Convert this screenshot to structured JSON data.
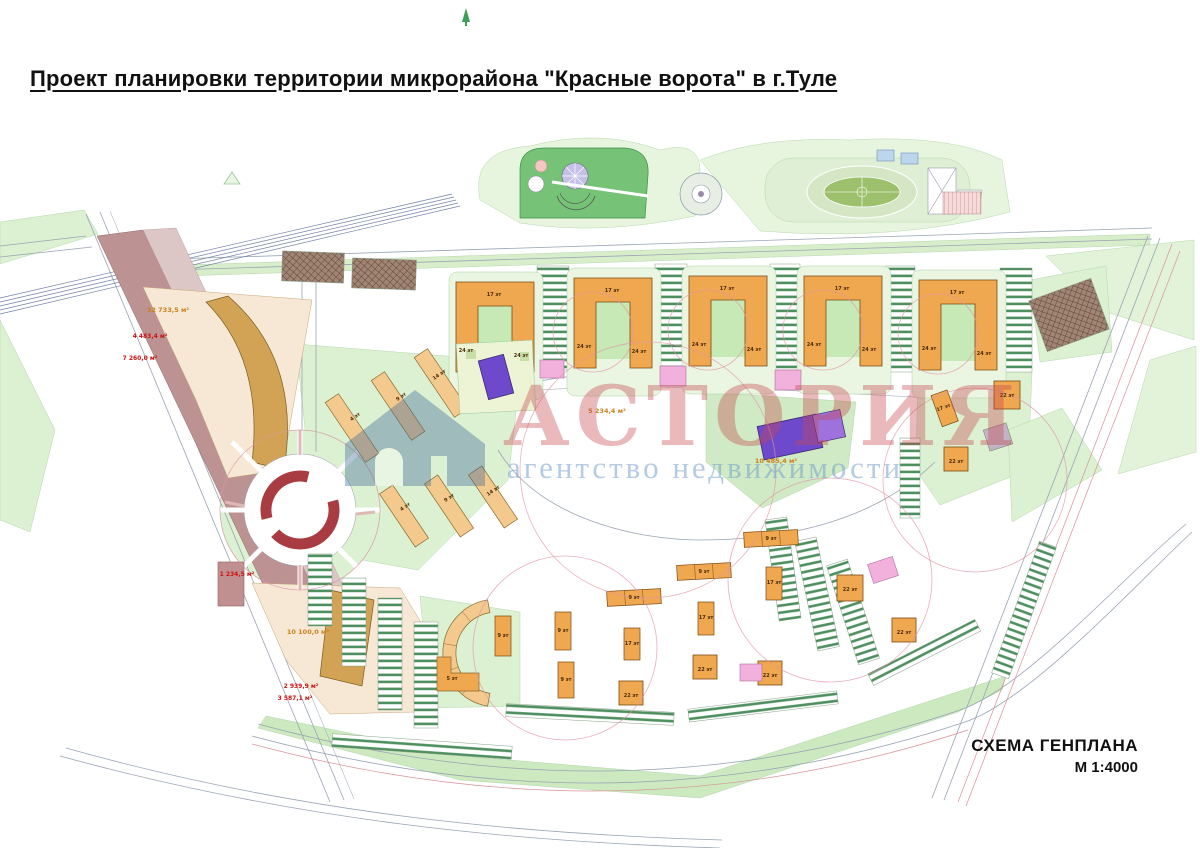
{
  "title": "Проект планировки территории микрорайона \"Красные ворота\" в г.Туле",
  "footer": {
    "scheme_label": "СХЕМА ГЕНПЛАНА",
    "scale_label": "М 1:4000"
  },
  "watermark": {
    "name": "АСТОРИЯ",
    "subtitle": "агентство недвижимости",
    "logo": "house-icon"
  },
  "palette": {
    "building_orange": "#efa750",
    "building_pale_orange": "#f3c98e",
    "building_tan": "#d2a355",
    "building_purple": "#6e49cb",
    "building_purple_light": "#9e72dc",
    "substation_pink": "#f2b0dc",
    "green_light": "#dcf0d2",
    "green_court": "#c6e9b6",
    "park_green": "#76c276",
    "corridor_mauve": "#bc9292",
    "parcel_beige": "#f6e8d4",
    "ring_red": "#a93b42",
    "label_red": "#c81414",
    "label_orange": "#c8821e"
  },
  "map": {
    "labels": [
      {
        "t": "17 эт",
        "x": 494,
        "y": 296,
        "c": "bld"
      },
      {
        "t": "24 эт",
        "x": 466,
        "y": 352,
        "c": "bld"
      },
      {
        "t": "24 эт",
        "x": 521,
        "y": 357,
        "c": "bld"
      },
      {
        "t": "17 эт",
        "x": 612,
        "y": 292,
        "c": "bld"
      },
      {
        "t": "24 эт",
        "x": 584,
        "y": 348,
        "c": "bld"
      },
      {
        "t": "24 эт",
        "x": 639,
        "y": 353,
        "c": "bld"
      },
      {
        "t": "17 эт",
        "x": 727,
        "y": 290,
        "c": "bld"
      },
      {
        "t": "24 эт",
        "x": 699,
        "y": 346,
        "c": "bld"
      },
      {
        "t": "24 эт",
        "x": 754,
        "y": 351,
        "c": "bld"
      },
      {
        "t": "17 эт",
        "x": 842,
        "y": 290,
        "c": "bld"
      },
      {
        "t": "24 эт",
        "x": 814,
        "y": 346,
        "c": "bld"
      },
      {
        "t": "24 эт",
        "x": 869,
        "y": 351,
        "c": "bld"
      },
      {
        "t": "17 эт",
        "x": 957,
        "y": 294,
        "c": "bld"
      },
      {
        "t": "24 эт",
        "x": 929,
        "y": 350,
        "c": "bld"
      },
      {
        "t": "24 эт",
        "x": 984,
        "y": 355,
        "c": "bld"
      },
      {
        "t": "4 эт",
        "x": 356,
        "y": 418,
        "c": "bld",
        "r": -34
      },
      {
        "t": "9 эт",
        "x": 402,
        "y": 398,
        "c": "bld",
        "r": -34
      },
      {
        "t": "14 эт",
        "x": 440,
        "y": 376,
        "c": "bld",
        "r": -34
      },
      {
        "t": "4 эт",
        "x": 406,
        "y": 508,
        "c": "bld",
        "r": -34
      },
      {
        "t": "9 эт",
        "x": 450,
        "y": 499,
        "c": "bld",
        "r": -34
      },
      {
        "t": "14 эт",
        "x": 494,
        "y": 492,
        "c": "bld",
        "r": -34
      },
      {
        "t": "9 эт",
        "x": 771,
        "y": 540,
        "c": "bld"
      },
      {
        "t": "9 эт",
        "x": 704,
        "y": 573,
        "c": "bld"
      },
      {
        "t": "9 эт",
        "x": 634,
        "y": 599,
        "c": "bld"
      },
      {
        "t": "9 эт",
        "x": 503,
        "y": 637,
        "c": "bld"
      },
      {
        "t": "9 эт",
        "x": 563,
        "y": 632,
        "c": "bld"
      },
      {
        "t": "9 эт",
        "x": 566,
        "y": 681,
        "c": "bld"
      },
      {
        "t": "17 эт",
        "x": 632,
        "y": 645,
        "c": "bld"
      },
      {
        "t": "17 эт",
        "x": 706,
        "y": 619,
        "c": "bld"
      },
      {
        "t": "17 эт",
        "x": 774,
        "y": 584,
        "c": "bld"
      },
      {
        "t": "17 эт",
        "x": 944,
        "y": 409,
        "c": "bld",
        "r": -20
      },
      {
        "t": "22 эт",
        "x": 631,
        "y": 697,
        "c": "bld"
      },
      {
        "t": "22 эт",
        "x": 705,
        "y": 671,
        "c": "bld"
      },
      {
        "t": "22 эт",
        "x": 770,
        "y": 677,
        "c": "bld"
      },
      {
        "t": "22 эт",
        "x": 850,
        "y": 591,
        "c": "bld"
      },
      {
        "t": "22 эт",
        "x": 904,
        "y": 634,
        "c": "bld"
      },
      {
        "t": "22 эт",
        "x": 1007,
        "y": 397,
        "c": "bld"
      },
      {
        "t": "22 эт",
        "x": 956,
        "y": 463,
        "c": "bld"
      },
      {
        "t": "5 эт",
        "x": 452,
        "y": 680,
        "c": "bld"
      },
      {
        "t": "32 733,5 м²",
        "x": 168,
        "y": 312,
        "c": "orange"
      },
      {
        "t": "4 483,4 м²",
        "x": 150,
        "y": 338,
        "c": "red"
      },
      {
        "t": "7 260,0 м²",
        "x": 140,
        "y": 360,
        "c": "red"
      },
      {
        "t": "1 234,5 м²",
        "x": 237,
        "y": 576,
        "c": "red"
      },
      {
        "t": "10 100,0 м²",
        "x": 308,
        "y": 634,
        "c": "orange"
      },
      {
        "t": "2 939,9 м²",
        "x": 301,
        "y": 688,
        "c": "red"
      },
      {
        "t": "3 587,1 м²",
        "x": 295,
        "y": 700,
        "c": "red"
      },
      {
        "t": "5 234,4 м²",
        "x": 607,
        "y": 413,
        "c": "orange"
      },
      {
        "t": "10 485,4 м²",
        "x": 776,
        "y": 463,
        "c": "orange"
      }
    ]
  }
}
